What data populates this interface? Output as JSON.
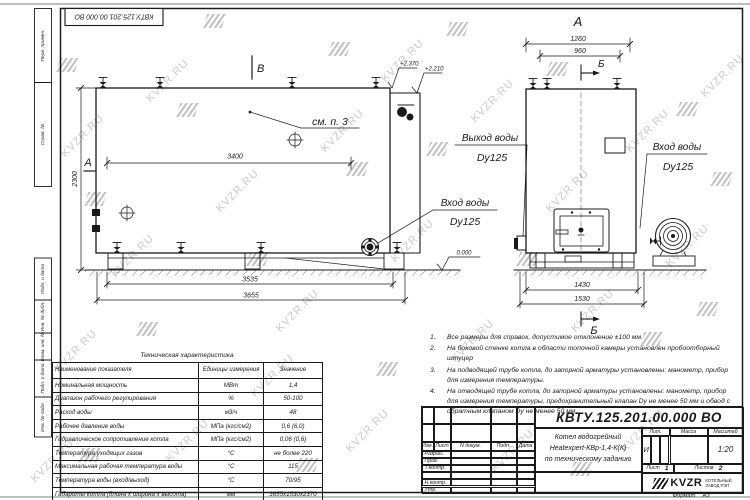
{
  "doc_number": "КВТУ.125.201.00.000 ВО",
  "watermark": {
    "text": "KVZR.RU"
  },
  "margin": {
    "l1": "Перв. примен.",
    "l2": "Справ. №",
    "l3": "Подп. и дата",
    "l4": "Инв. № дубл.",
    "l5": "Взам. инв. №",
    "l6": "Подп. и дата",
    "l7": "Инв. № подл."
  },
  "main_view": {
    "marker_a": "А",
    "marker_b": "В",
    "see_note": "см. п. 3",
    "elev1": "+2.370",
    "elev2": "+2.210",
    "elev_zero": "0.000",
    "dim_width": "3400",
    "dim_height": "2300",
    "dim_bottom1": "3535",
    "dim_bottom2": "3655",
    "inlet_l1": "Вход воды",
    "inlet_l2": "Dy125"
  },
  "end_view": {
    "view_label": "А",
    "section_top": "Б",
    "section_bottom": "Б",
    "dim_top1": "1260",
    "dim_top2": "960",
    "dim_bottom1": "1430",
    "dim_bottom2": "1530",
    "outlet_l1": "Выход воды",
    "outlet_l2": "Dy125",
    "inlet_l1": "Вход воды",
    "inlet_l2": "Dy125"
  },
  "notes": [
    {
      "num": "1.",
      "text": "Все размеры для справок, допустимое отклонение ±100 мм."
    },
    {
      "num": "2.",
      "text": "На боковой стенке котла в области топочной камеры установлен пробоотборный штуцер"
    },
    {
      "num": "3.",
      "text": "На подводящей трубе котла, до запорной арматуры установлены: манометр, прибор для измерения температуры."
    },
    {
      "num": "4.",
      "text": "На отводящей трубе котла, до запорной арматуры установлены: манометр, прибор для измерения температуры, предохранительный клапан Dу не менее 50 мм и обвод с обратным клапаном Dу не менее 50 мм."
    }
  ],
  "tech_table": {
    "title": "Техническая характеристика",
    "headers": [
      "Наименование показателя",
      "Единицы измерения",
      "Значение"
    ],
    "rows": [
      [
        "Номинальная мощность",
        "МВт",
        "1,4"
      ],
      [
        "Диапазон рабочего регулирования",
        "%",
        "50-100"
      ],
      [
        "Расход воды",
        "м3/ч",
        "48"
      ],
      [
        "Рабочее давление воды",
        "МПа (кгс/см2)",
        "0,6 (6,0)"
      ],
      [
        "Гидравлическое сопротивление котла",
        "МПа (кгс/см2)",
        "0,06 (0,6)"
      ],
      [
        "Температура уходящих газов",
        "°С",
        "не более 220"
      ],
      [
        "Максимальная рабочая температура воды",
        "°С",
        "115"
      ],
      [
        "Температура воды (вход/выход)",
        "°С",
        "70/95"
      ],
      [
        "Габариты котла (длина х ширина х высота)",
        "мм",
        "3655х1530х2370"
      ]
    ]
  },
  "title_block": {
    "cols": [
      "Изм.",
      "Лист",
      "N докум.",
      "Подп.",
      "Дата"
    ],
    "roles": [
      "Разраб.",
      "Пров.",
      "Т.контр.",
      "",
      "Н.контр.",
      "Утв."
    ],
    "name1": "Котел водогрейный",
    "name2": "Heatexpert-КВр-1,4-К(К)",
    "name3": "по техническому заданию",
    "lit": "Лит.",
    "lit_value": "И",
    "mass": "Масса",
    "scale": "Масштаб",
    "scale_value": "1:20",
    "sheet": "Лист",
    "sheet_value": "1",
    "sheets": "Листов",
    "sheets_value": "2",
    "logo": "KVZR",
    "company1": "КОТЕЛЬНЫЙ",
    "company2": "ЗАВОД РЭП",
    "format_label": "Формат",
    "format_value": "А3"
  }
}
